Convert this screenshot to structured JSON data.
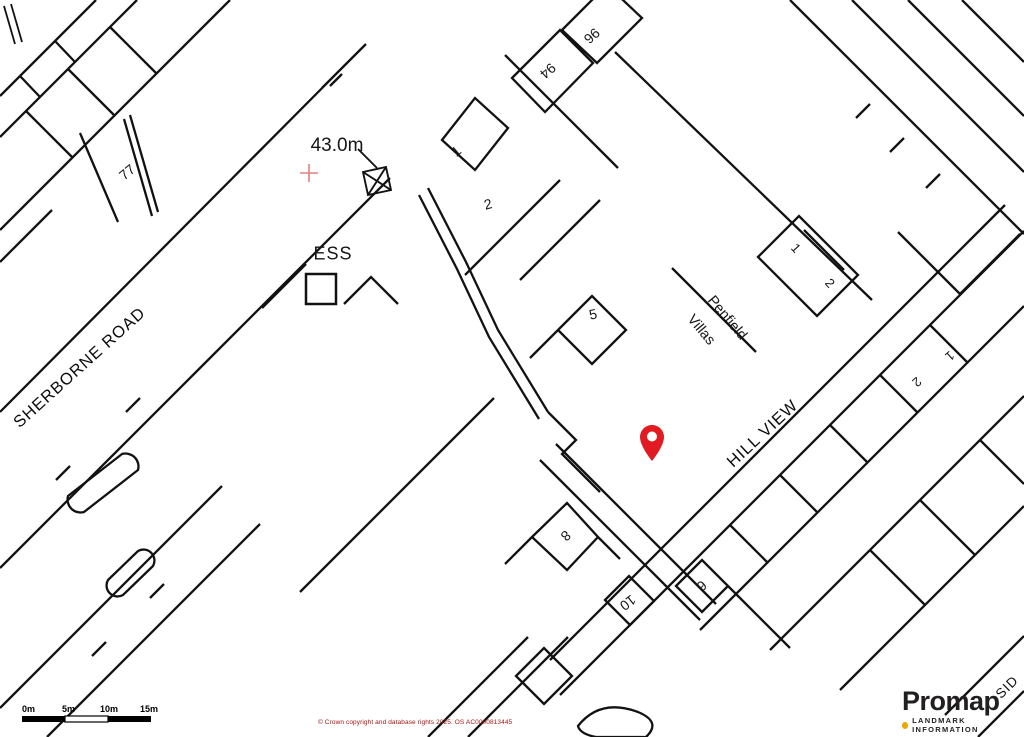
{
  "map": {
    "spot_height_label": "43.0m",
    "substation_label": "ESS",
    "street_1": "SHERBORNE ROAD",
    "street_2": "HILL VIEW",
    "street_3": "SID",
    "place_line1": "Penfield",
    "place_line2": "Villas",
    "numbers": {
      "n77": "77",
      "n1a": "1",
      "n2a": "2",
      "n94": "94",
      "n96": "96",
      "n5": "5",
      "n1b": "1",
      "n2b": "2",
      "n1c": "1",
      "n2c": "2",
      "n8": "8",
      "n10": "10",
      "n6": "6"
    },
    "pin_color": "#e01b22",
    "benchmark_cross_color": "#e08080",
    "line_color": "#121212",
    "background_color": "#ffffff"
  },
  "scalebar": {
    "t0": "0m",
    "t5": "5m",
    "t10": "10m",
    "t15": "15m"
  },
  "footer": {
    "copyright": "© Crown copyright and database rights 2025. OS AC0000813445"
  },
  "logo": {
    "brand": "Promap",
    "tagline": "LANDMARK INFORMATION",
    "dot_color": "#efa500"
  }
}
